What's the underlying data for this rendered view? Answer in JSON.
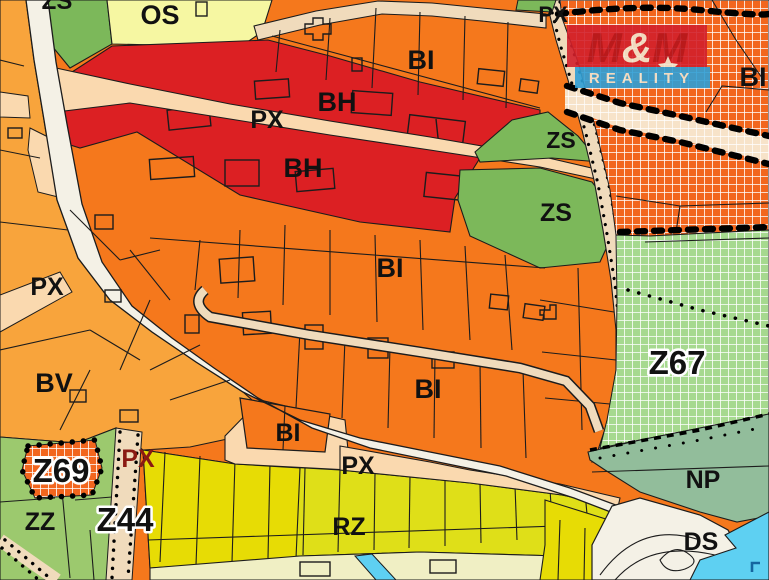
{
  "map": {
    "watermark": {
      "m_left": "M",
      "ampersand": "&",
      "m_right": "M",
      "subtitle": "REALITY"
    },
    "labels": [
      {
        "id": "zs-top-cut",
        "text": "ZS"
      },
      {
        "id": "os",
        "text": "OS"
      },
      {
        "id": "bi-top",
        "text": "BI"
      },
      {
        "id": "px-top-right",
        "text": "PX"
      },
      {
        "id": "bi-right",
        "text": "BI"
      },
      {
        "id": "bh-upper",
        "text": "BH"
      },
      {
        "id": "px-red-zone",
        "text": "PX"
      },
      {
        "id": "bh-lower",
        "text": "BH"
      },
      {
        "id": "zs-small",
        "text": "ZS"
      },
      {
        "id": "zs-big",
        "text": "ZS"
      },
      {
        "id": "bi-middle",
        "text": "BI"
      },
      {
        "id": "px-left",
        "text": "PX"
      },
      {
        "id": "bv",
        "text": "BV"
      },
      {
        "id": "bi-middle-2",
        "text": "BI"
      },
      {
        "id": "z67",
        "text": "Z67"
      },
      {
        "id": "bi-small",
        "text": "BI"
      },
      {
        "id": "px-bottom",
        "text": "PX"
      },
      {
        "id": "px-dark-red",
        "text": "PX"
      },
      {
        "id": "z69",
        "text": "Z69"
      },
      {
        "id": "zz",
        "text": "ZZ"
      },
      {
        "id": "z44",
        "text": "Z44"
      },
      {
        "id": "rz",
        "text": "RZ"
      },
      {
        "id": "np",
        "text": "NP"
      },
      {
        "id": "ds",
        "text": "DS"
      }
    ],
    "colors": {
      "bi_orange": "#f5781c",
      "bv_amber": "#f8a43c",
      "bh_red": "#dc2023",
      "os_yellow": "#f6f7a2",
      "zs_green": "#7cb85a",
      "zz_green": "#9cc96e",
      "z67_green_grid": "#a6d98f",
      "orange_grid": "#f2661e",
      "px_peach": "#fad9af",
      "px_peach_grid": "#f7e3c9",
      "road_white": "#f4f1e6",
      "tan_road": "#f0dbbc",
      "rz_yellow_green": "#dfdf18",
      "bright_yellow": "#e7dc05",
      "np_sage": "#92bd9b",
      "cyan_water": "#5ed0f2",
      "cream_strip": "#f0efc4",
      "outline": "#1c1c1c",
      "label_black": "#111111",
      "label_dark_red": "#8a1a12",
      "logo_red": "#d2202b",
      "logo_m_red": "#b5121b",
      "logo_blue": "#2e9fd6",
      "logo_cream": "#f2e6d0"
    }
  }
}
